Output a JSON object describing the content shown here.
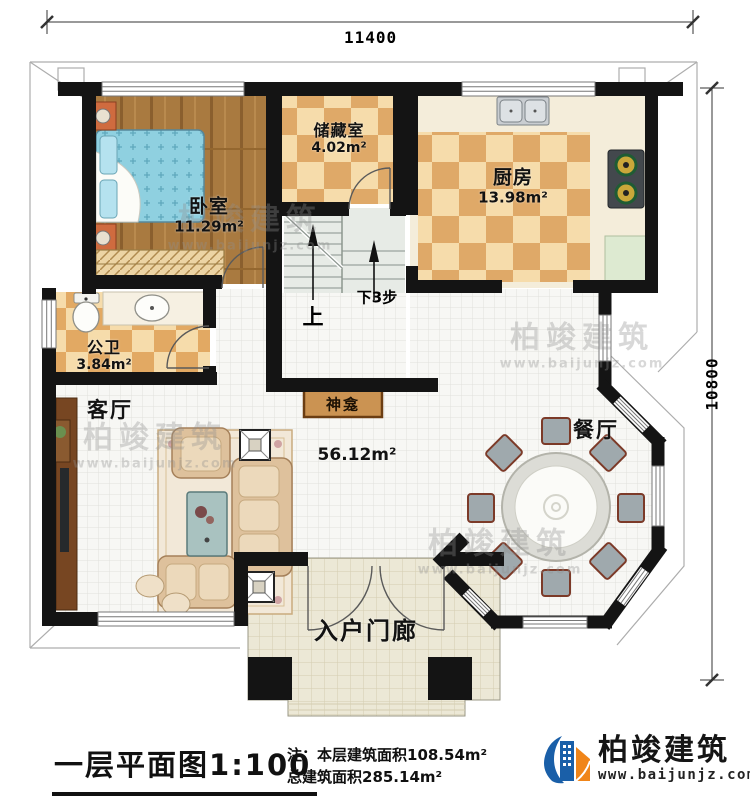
{
  "dimensions": {
    "top": "11400",
    "right": "10800"
  },
  "rooms": {
    "bedroom": {
      "name": "卧室",
      "area": "11.29m²"
    },
    "storage": {
      "name": "储藏室",
      "area": "4.02m²"
    },
    "kitchen": {
      "name": "厨房",
      "area": "13.98m²"
    },
    "bathroom": {
      "name": "公卫",
      "area": "3.84m²"
    },
    "living": {
      "name": "客厅",
      "area": "56.12m²"
    },
    "shrine": {
      "name": "神龛"
    },
    "dining": {
      "name": "餐厅"
    },
    "porch": {
      "name": "入户门廊"
    }
  },
  "stairs": {
    "up": "上",
    "down": "下3步"
  },
  "titleblock": {
    "title": "一层平面图",
    "scale": "1:100",
    "note_line1": "注：本层建筑面积108.54m²",
    "note_line2": "总建筑面积285.14m²"
  },
  "brand": {
    "name": "柏竣建筑",
    "website": "www.baijunjz.com"
  },
  "watermark": {
    "line1": "柏竣建筑",
    "line2": "www.baijunjz.com"
  },
  "colors": {
    "wall": "#141414",
    "wood_floor": "#a97a40",
    "checker_dark": "#dfa968",
    "checker_light": "#f6dcab",
    "tile": "#f7f7f4",
    "porch_tile": "#ece8d6",
    "brand_blue": "#1a5fa8",
    "brand_orange": "#f08519"
  }
}
